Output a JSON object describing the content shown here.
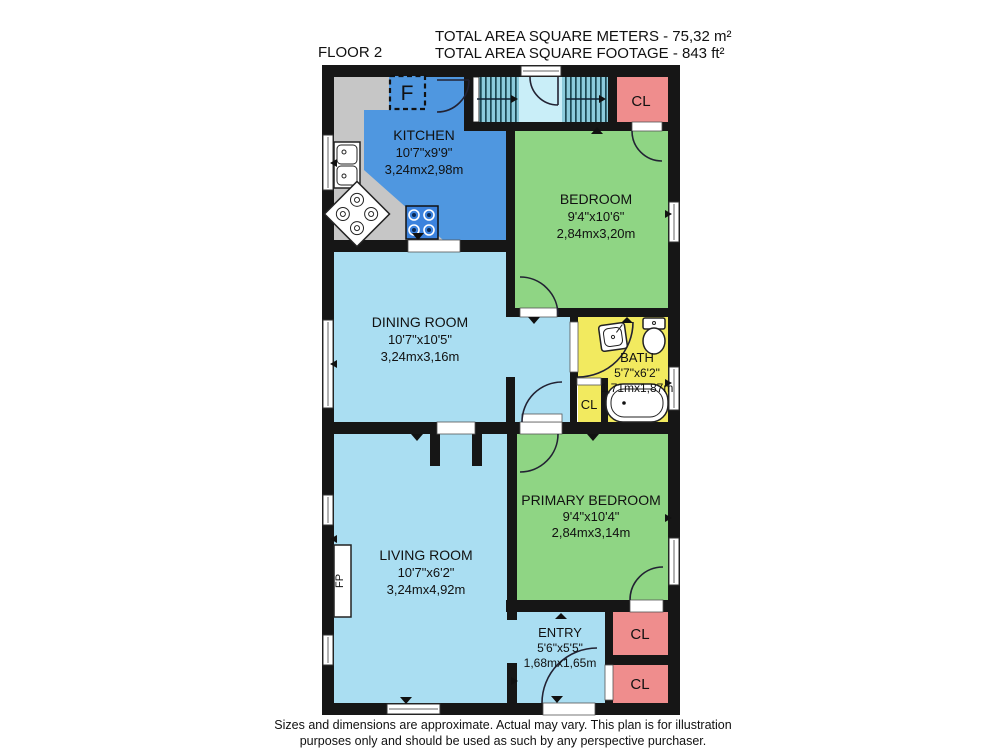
{
  "header": {
    "floor_label": "FLOOR 2",
    "area_meters": "TOTAL AREA SQUARE METERS - 75,32 m²",
    "area_feet": "TOTAL AREA SQUARE FOOTAGE - 843 ft²"
  },
  "rooms": {
    "kitchen": {
      "name": "KITCHEN",
      "imperial": "10'7\"x9'9\"",
      "metric": "3,24mx2,98m"
    },
    "bedroom": {
      "name": "BEDROOM",
      "imperial": "9'4\"x10'6\"",
      "metric": "2,84mx3,20m"
    },
    "dining": {
      "name": "DINING ROOM",
      "imperial": "10'7\"x10'5\"",
      "metric": "3,24mx3,16m"
    },
    "bath": {
      "name": "BATH",
      "imperial": "5'7\"x6'2\"",
      "metric": "1,71mx1,87m"
    },
    "living": {
      "name": "LIVING ROOM",
      "imperial": "10'7\"x6'2\"",
      "metric": "3,24mx4,92m"
    },
    "primary": {
      "name": "PRIMARY BEDROOM",
      "imperial": "9'4\"x10'4\"",
      "metric": "2,84mx3,14m"
    },
    "entry": {
      "name": "ENTRY",
      "imperial": "5'6\"x5'5\"",
      "metric": "1,68mx1,65m"
    }
  },
  "closet_label": "CL",
  "fixtures": {
    "fridge": "F",
    "fireplace": "FP"
  },
  "footer": {
    "line1": "Sizes and dimensions are approximate. Actual may vary. This plan is for illustration",
    "line2": "purposes only and should be used as such by any perspective purchaser."
  },
  "colors": {
    "wall": "#161616",
    "kitchen_floor": "#4f97e0",
    "light_floor": "#aadef2",
    "bedroom_floor": "#8fd584",
    "bath_floor": "#f2ea5f",
    "closet": "#ef8d8d",
    "counter": "#c6c6c6",
    "stairs_bg": "#8ccbdc",
    "landing": "#c9eef8",
    "range_blue": "#3b82dd"
  }
}
